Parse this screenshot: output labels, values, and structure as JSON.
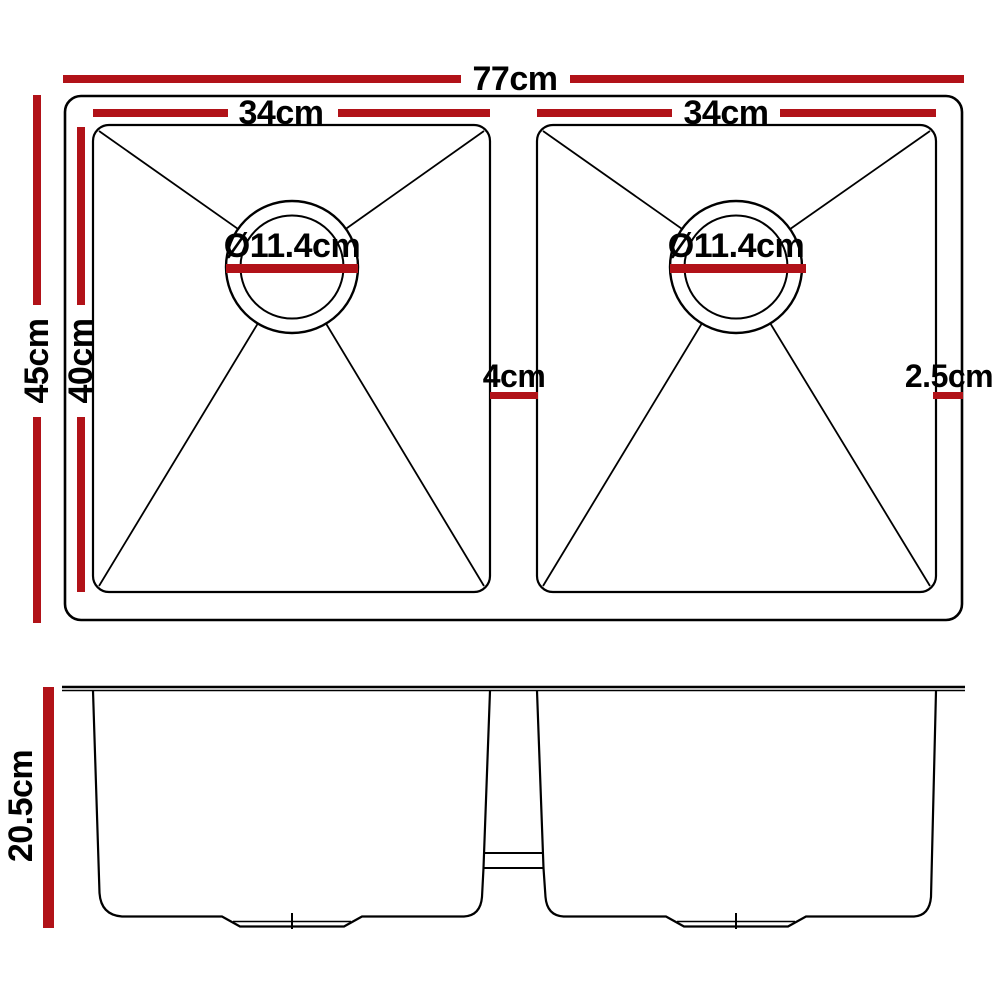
{
  "colors": {
    "dimension_red": "#b11218",
    "line_black": "#000000",
    "background": "#ffffff"
  },
  "top_view": {
    "overall_width_label": "77cm",
    "overall_depth_label": "45cm",
    "bowl_depth_label": "40cm",
    "left_bowl": {
      "width_label": "34cm",
      "drain_diameter_label": "Ø11.4cm"
    },
    "right_bowl": {
      "width_label": "34cm",
      "drain_diameter_label": "Ø11.4cm"
    },
    "center_divider_width_label": "4cm",
    "right_edge_gap_label": "2.5cm"
  },
  "side_view": {
    "bowl_depth_label": "20.5cm"
  }
}
